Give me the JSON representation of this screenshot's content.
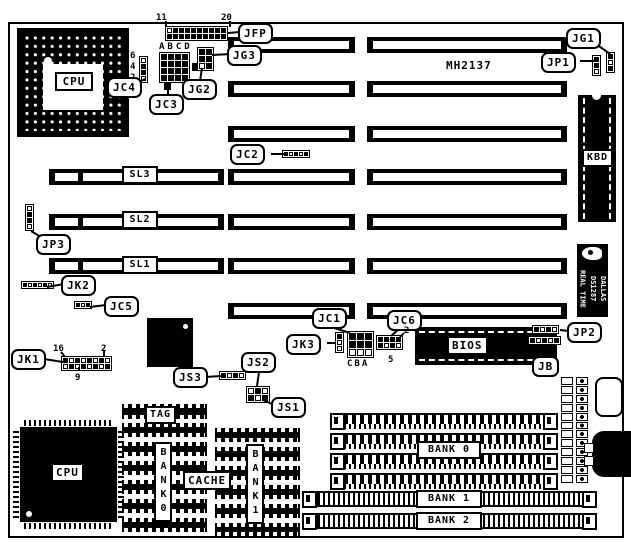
{
  "model": "MH2137",
  "connectors": {
    "jfp": "JFP",
    "jg3": "JG3",
    "jg2": "JG2",
    "jc4": "JC4",
    "jc3": "JC3",
    "jc2": "JC2",
    "jg1": "JG1",
    "jp1": "JP1",
    "jp3": "JP3",
    "jk2": "JK2",
    "jc5": "JC5",
    "jk1": "JK1",
    "js3": "JS3",
    "js2": "JS2",
    "js1": "JS1",
    "jk3": "JK3",
    "jc1": "JC1",
    "jc6": "JC6",
    "jp2": "JP2",
    "jb": "JB"
  },
  "slots": {
    "sl1": "SL1",
    "sl2": "SL2",
    "sl3": "SL3"
  },
  "chips": {
    "cpu_socket": "CPU",
    "cpu_qfp": "CPU",
    "kbd": "KBD",
    "bios": "BIOS",
    "tag": "TAG",
    "cache": "CACHE",
    "dallas_line1": "DALLAS",
    "dallas_line2": "DS1287",
    "dallas_line3": "REAL TIME"
  },
  "memory": {
    "bank0": "BANK 0",
    "bank1": "BANK 1",
    "bank2": "BANK 2",
    "cache_bank0": "BANK0",
    "cache_bank1": "BANK1"
  },
  "pin_labels": {
    "jfp_pin11": "11",
    "jfp_pin20": "20",
    "jc4_pin6": "6",
    "jc4_pin4": "4",
    "jc4_pin2": "2",
    "jc3_cols": "ABCD",
    "jk1_pin16": "16",
    "jk1_pin2": "2",
    "jk1_pin9": "9",
    "jc1_cols": "CBA",
    "jc6_pin2": "2",
    "jc6_pin5": "5"
  }
}
